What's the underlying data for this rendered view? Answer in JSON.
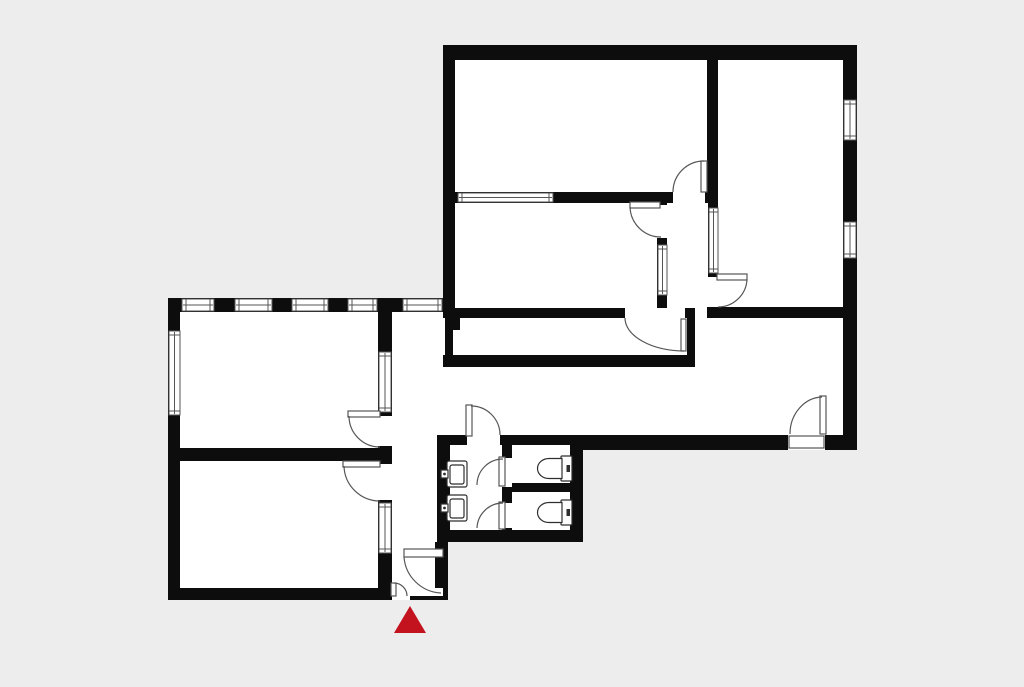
{
  "canvas": {
    "width": 1024,
    "height": 682,
    "background_color": "#ededed"
  },
  "palette": {
    "wall": "#0d0d0d",
    "floor": "#ffffff",
    "line": "#565656",
    "fixture_line": "#2f2f2f",
    "marker_red": "#c3131f"
  },
  "entrance_marker": {
    "shape": "triangle",
    "color": "#c3131f",
    "points": "410,606 394,633 426,633"
  },
  "inventory": {
    "doors": 12,
    "windows": 13,
    "toilets": 2,
    "sinks": 2
  }
}
